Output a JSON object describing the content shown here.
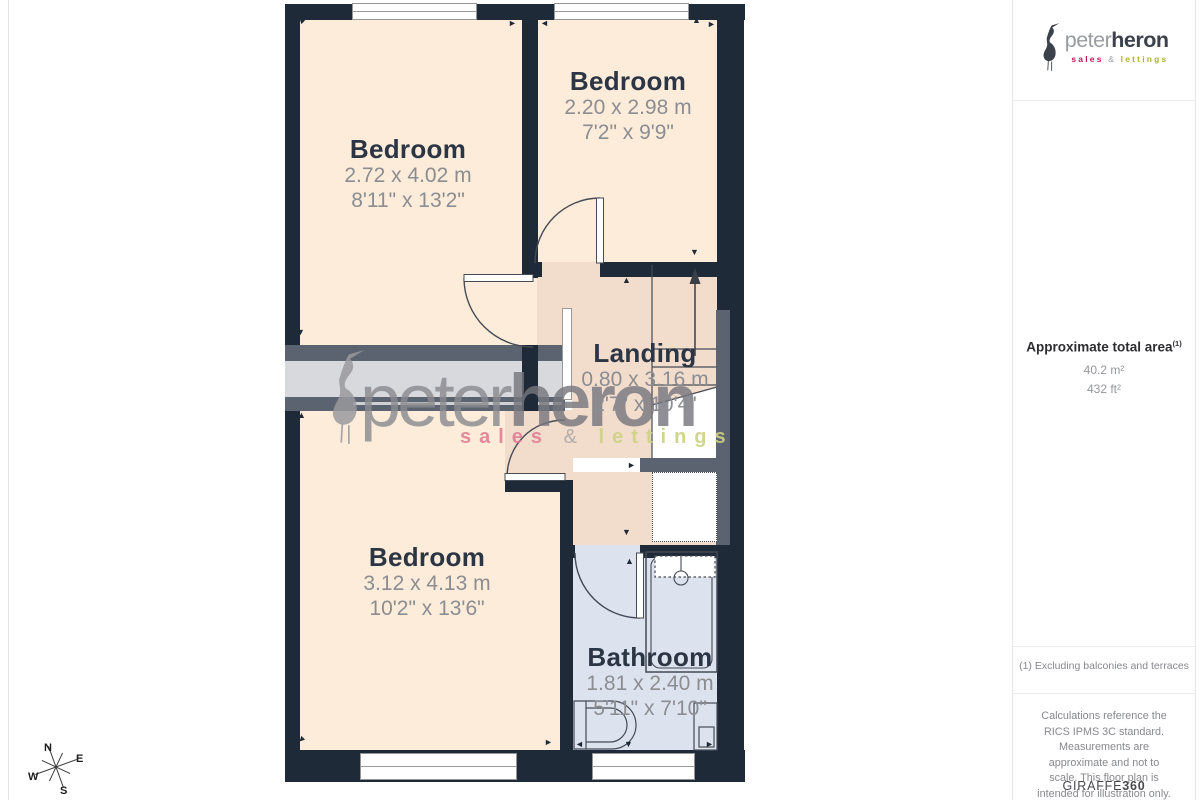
{
  "floorplan": {
    "rooms": [
      {
        "id": "bedroom-1",
        "name": "Bedroom",
        "metric": "2.72 x 4.02 m",
        "imperial": "8'11\" x 13'2\""
      },
      {
        "id": "bedroom-2",
        "name": "Bedroom",
        "metric": "2.20 x 2.98 m",
        "imperial": "7'2\" x 9'9\""
      },
      {
        "id": "landing",
        "name": "Landing",
        "metric": "0.80 x 3.16 m",
        "imperial": "2'7\" x 10'4\""
      },
      {
        "id": "bedroom-3",
        "name": "Bedroom",
        "metric": "3.12 x 4.13 m",
        "imperial": "10'2\" x 13'6\""
      },
      {
        "id": "bathroom",
        "name": "Bathroom",
        "metric": "1.81 x 2.40 m",
        "imperial": "5'11\" x 7'10\""
      }
    ],
    "compass": {
      "n": "N",
      "e": "E",
      "s": "S",
      "w": "W"
    }
  },
  "watermark": {
    "brand_part1": "peter",
    "brand_part2": "heron",
    "tagline_sales": "sales",
    "tagline_amp": "&",
    "tagline_lettings": "lettings"
  },
  "sidebar": {
    "logo": {
      "brand_part1": "peter",
      "brand_part2": "heron",
      "tagline_sales": "sales",
      "tagline_amp": "&",
      "tagline_lettings": "lettings"
    },
    "area": {
      "title": "Approximate total area",
      "superscript": "(1)",
      "metric": "40.2 m²",
      "imperial": "432 ft²"
    },
    "footnote1": "(1) Excluding balconies and terraces",
    "disclaimer": "Calculations reference the RICS IPMS 3C standard. Measurements are approximate and not to scale. This floor plan is intended for illustration only.",
    "credit_brand": "GIRAFFE",
    "credit_suffix": "360"
  },
  "colors": {
    "wall": "#1f2a38",
    "room_fill": "#fcecd9",
    "landing_fill": "#f2dccc",
    "bathroom_fill": "#dde3ee",
    "void_fill": "#d8d9dd",
    "void_wall": "#5c6370",
    "label": "#2b3544",
    "dim_text": "#8b8d92",
    "logo_dark": "#3b424b",
    "logo_gray": "#989ca1",
    "logo_pink": "#c21557",
    "logo_olive": "#acb52a"
  }
}
